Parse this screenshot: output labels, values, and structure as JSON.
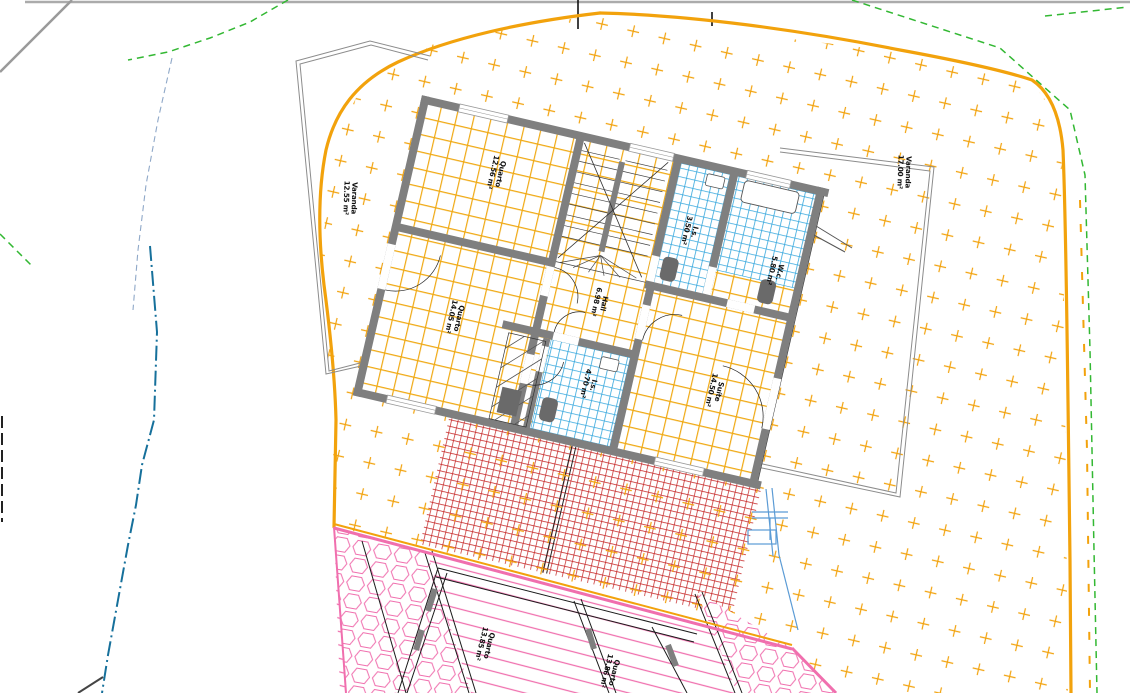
{
  "drawing": {
    "type": "architectural floor plan",
    "floor": "upper floor of semi-detached house with site plan"
  },
  "rooms": {
    "varanda_left": {
      "name": "Varanda",
      "area": "12.55 m²"
    },
    "quarto1": {
      "name": "Quarto",
      "area": "12.56 m²"
    },
    "quarto2": {
      "name": "Quarto",
      "area": "14.05 m²"
    },
    "is1": {
      "name": "I.s.",
      "area": "3.50 m²"
    },
    "wc": {
      "name": "W.c.",
      "area": "5.80 m²"
    },
    "hall": {
      "name": "Hall",
      "area": "6.98 m²"
    },
    "is2": {
      "name": "I.s.",
      "area": "4.70 m²"
    },
    "suite": {
      "name": "Suíte",
      "area": "14.50 m²"
    },
    "varanda_right": {
      "name": "Varanda",
      "area": "17.00 m²"
    },
    "quarto_low_left": {
      "name": "Quarto",
      "area": "13.85 m²"
    },
    "quarto_low_right": {
      "name": "Quarto",
      "area": "13.86 m²"
    }
  },
  "colors": {
    "amber": "#F2A20C",
    "tile_yellow": "#F0A913",
    "blue_tile": "#35A7DD",
    "red_paver": "#C42020",
    "pink": "#F06FAE",
    "green_dashed": "#33B833",
    "teal_dashdot": "#16709B",
    "light_blue": "#5B9BD5",
    "wall_gray": "#7F7F7F",
    "road_gray": "#9A9A9A"
  }
}
